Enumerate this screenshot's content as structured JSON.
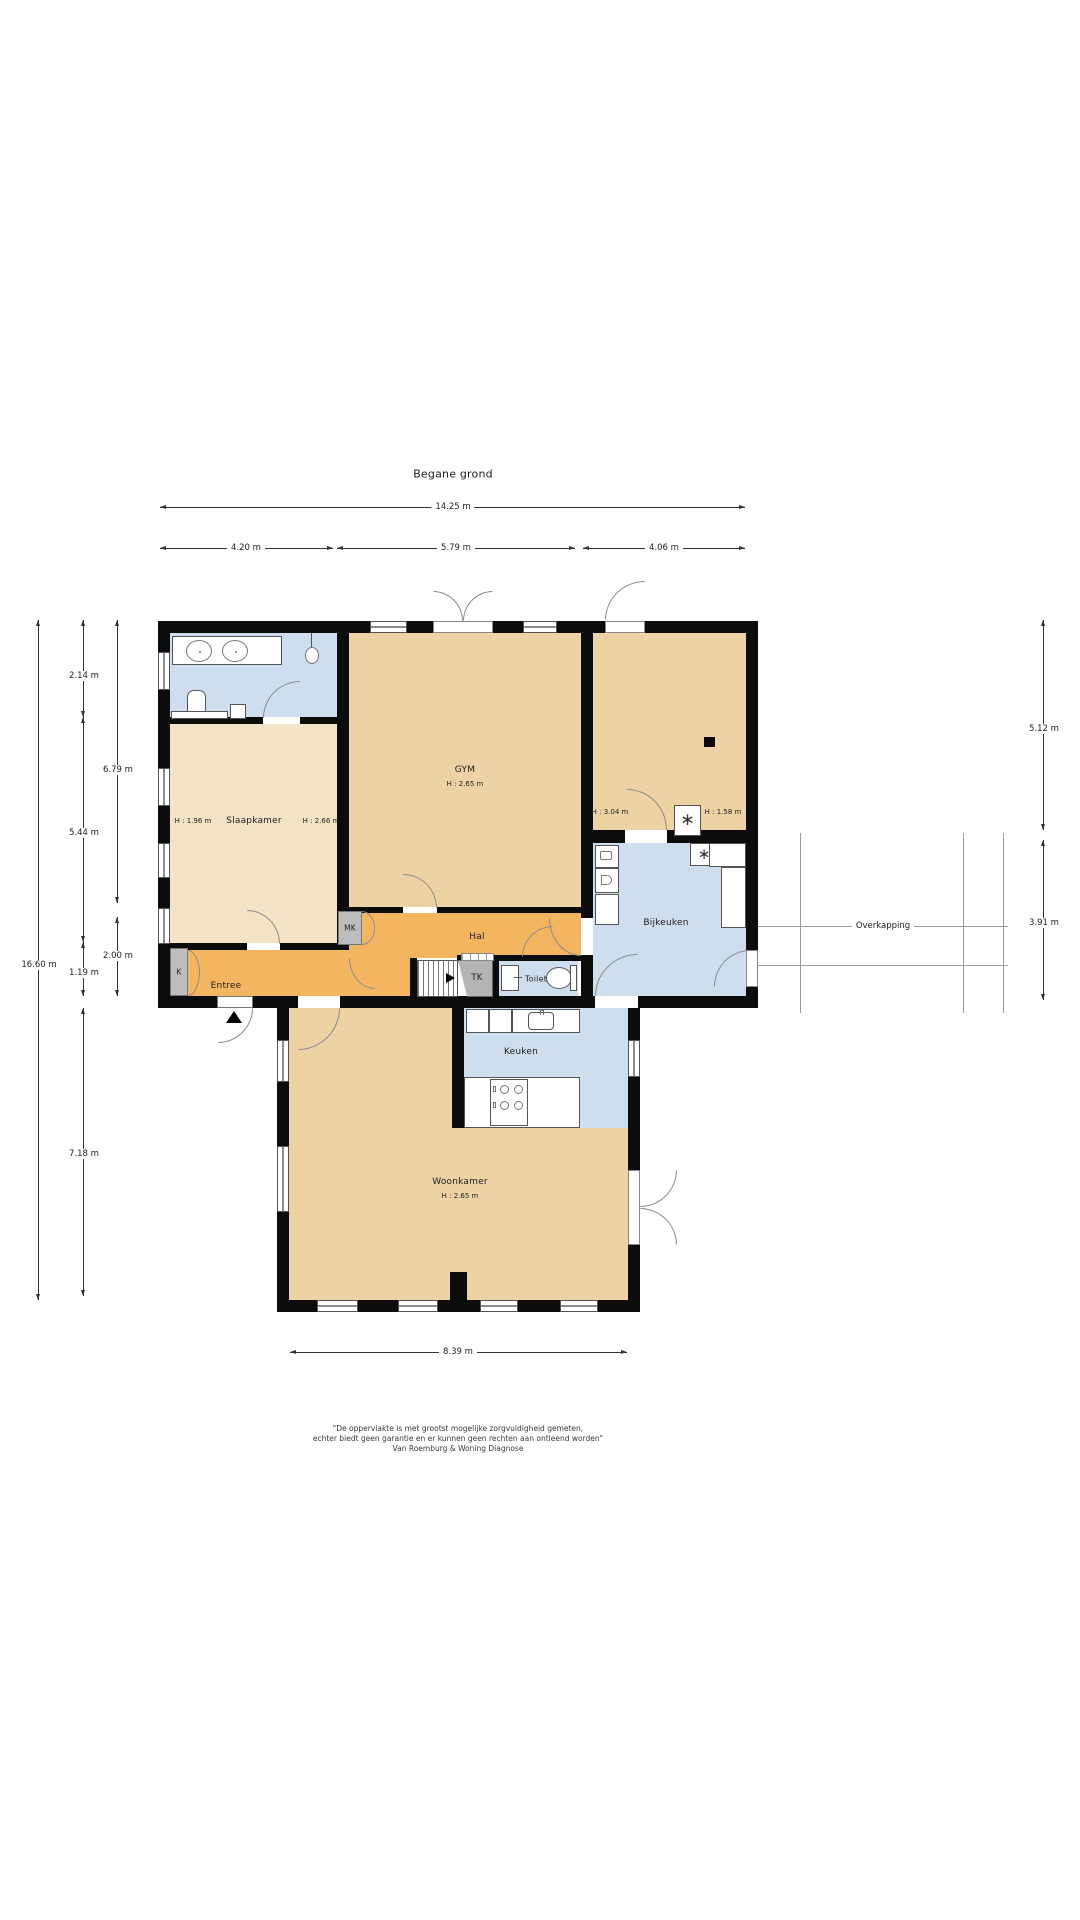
{
  "title": "Begane grond",
  "rooms": {
    "gym": {
      "label": "GYM",
      "h": "H : 2.65 m"
    },
    "slaapkamer": {
      "label": "Slaapkamer",
      "h_left": "H : 1.96 m",
      "h_right": "H : 2.66 m"
    },
    "right_room": {
      "h_left": "H : 3.04 m",
      "h_right": "H : 1.58 m"
    },
    "bijkeuken": {
      "label": "Bijkeuken"
    },
    "hal": {
      "label": "Hal"
    },
    "entree": {
      "label": "Entree"
    },
    "keuken": {
      "label": "Keuken"
    },
    "woonkamer": {
      "label": "Woonkamer",
      "h": "H : 2.65 m"
    },
    "toilet": {
      "label": "Toilet"
    },
    "tk": {
      "label": "TK"
    },
    "mk": {
      "label": "MK"
    },
    "k": {
      "label": "K"
    },
    "overkapping": {
      "label": "Overkapping"
    }
  },
  "icons": {
    "ventilation": "∗"
  },
  "colors": {
    "tan": "#edd3a4",
    "light_tan": "#f4e3c5",
    "orange": "#f3b55f",
    "blue": "#cfdeee",
    "wall": "#0c0c0c"
  },
  "dimensions": {
    "top_total": "14.25 m",
    "top_seg1": "4.20 m",
    "top_seg2": "5.79 m",
    "top_seg3": "4.06 m",
    "left_total": "16.60 m",
    "left_a1": "2.14 m",
    "left_a2": "5.44 m",
    "left_a3": "1.19 m",
    "left_a4": "7.18 m",
    "left_b1": "6.79 m",
    "left_b2": "2.00 m",
    "right_1": "5.12 m",
    "right_2": "3.91 m",
    "bottom": "8.39 m"
  },
  "disclaimer": {
    "line1": "\"De oppervlakte is met grootst mogelijke zorgvuldigheid gemeten,",
    "line2": "echter biedt geen garantie en er kunnen geen rechten aan ontleend worden\"",
    "line3": "Van Roemburg & Woning Diagnose"
  }
}
